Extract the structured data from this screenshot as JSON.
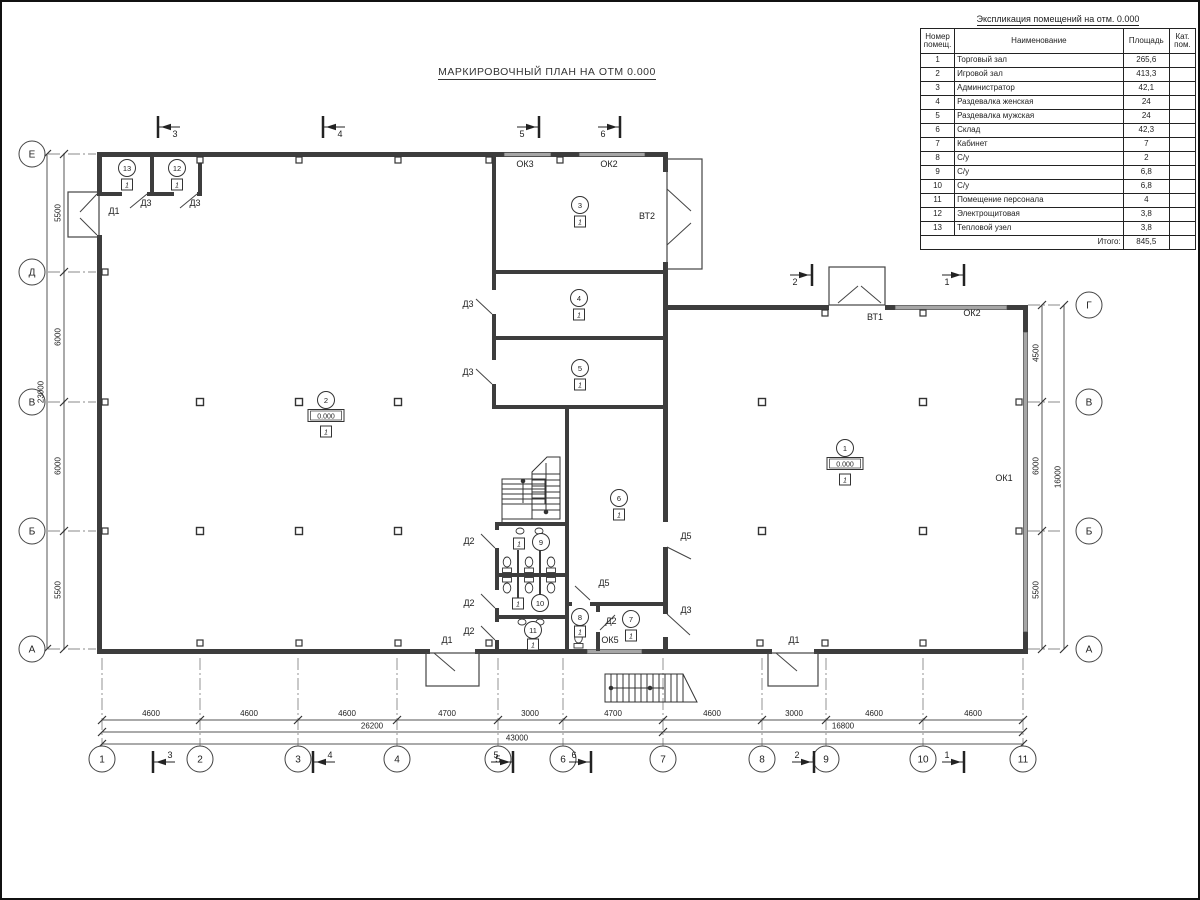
{
  "plan_title": "МАРКИРОВОЧНЫЙ ПЛАН НА ОТМ 0.000",
  "table": {
    "title": "Экспликация помещений на отм. 0.000",
    "h_num1": "Номер",
    "h_num2": "помещ.",
    "h_name": "Наименование",
    "h_area": "Площадь",
    "h_cat1": "Кат.",
    "h_cat2": "пом.",
    "rows": [
      {
        "n": "1",
        "name": "Торговый зал",
        "area": "265,6",
        "cat": ""
      },
      {
        "n": "2",
        "name": "Игровой зал",
        "area": "413,3",
        "cat": ""
      },
      {
        "n": "3",
        "name": "Администратор",
        "area": "42,1",
        "cat": ""
      },
      {
        "n": "4",
        "name": "Раздевалка женская",
        "area": "24",
        "cat": ""
      },
      {
        "n": "5",
        "name": "Раздевалка мужская",
        "area": "24",
        "cat": ""
      },
      {
        "n": "6",
        "name": "Склад",
        "area": "42,3",
        "cat": ""
      },
      {
        "n": "7",
        "name": "Кабинет",
        "area": "7",
        "cat": ""
      },
      {
        "n": "8",
        "name": "С/у",
        "area": "2",
        "cat": ""
      },
      {
        "n": "9",
        "name": "С/у",
        "area": "6,8",
        "cat": ""
      },
      {
        "n": "10",
        "name": "С/у",
        "area": "6,8",
        "cat": ""
      },
      {
        "n": "11",
        "name": "Помещение персонала",
        "area": "4",
        "cat": ""
      },
      {
        "n": "12",
        "name": "Электрощитовая",
        "area": "3,8",
        "cat": ""
      },
      {
        "n": "13",
        "name": "Тепловой узел",
        "area": "3,8",
        "cat": ""
      }
    ],
    "total_label": "Итого:",
    "total_value": "845,5"
  },
  "axes": {
    "bottom": [
      {
        "label": "1",
        "x": 100
      },
      {
        "label": "2",
        "x": 198
      },
      {
        "label": "3",
        "x": 296
      },
      {
        "label": "4",
        "x": 395
      },
      {
        "label": "5",
        "x": 496
      },
      {
        "label": "6",
        "x": 561
      },
      {
        "label": "7",
        "x": 661
      },
      {
        "label": "8",
        "x": 760
      },
      {
        "label": "9",
        "x": 824
      },
      {
        "label": "10",
        "x": 921
      },
      {
        "label": "11",
        "x": 1021
      }
    ],
    "left": [
      {
        "label": "Е",
        "y": 152
      },
      {
        "label": "Д",
        "y": 270
      },
      {
        "label": "В",
        "y": 400
      },
      {
        "label": "Б",
        "y": 529
      },
      {
        "label": "А",
        "y": 647
      }
    ],
    "right": [
      {
        "label": "Г",
        "y": 303
      },
      {
        "label": "В",
        "y": 400
      },
      {
        "label": "Б",
        "y": 529
      },
      {
        "label": "А",
        "y": 647
      }
    ]
  },
  "dims": {
    "bottom_row1": [
      {
        "text": "4600",
        "x": 149
      },
      {
        "text": "4600",
        "x": 247
      },
      {
        "text": "4600",
        "x": 345
      },
      {
        "text": "4700",
        "x": 445
      },
      {
        "text": "3000",
        "x": 528
      },
      {
        "text": "4700",
        "x": 611
      },
      {
        "text": "4600",
        "x": 710
      },
      {
        "text": "3000",
        "x": 792
      },
      {
        "text": "4600",
        "x": 872
      },
      {
        "text": "4600",
        "x": 971
      }
    ],
    "bottom_row2": [
      {
        "text": "26200",
        "x": 370
      },
      {
        "text": "16800",
        "x": 841
      }
    ],
    "bottom_total": {
      "text": "43000",
      "x": 515
    },
    "left_col": [
      {
        "text": "5500",
        "y": 211
      },
      {
        "text": "6000",
        "y": 335
      },
      {
        "text": "6000",
        "y": 464
      },
      {
        "text": "5500",
        "y": 588
      }
    ],
    "left_total": {
      "text": "23000",
      "y": 390
    },
    "right_col": [
      {
        "text": "4500",
        "y": 351
      },
      {
        "text": "6000",
        "y": 464
      },
      {
        "text": "5500",
        "y": 588
      }
    ],
    "right_total": {
      "text": "16000",
      "y": 475
    }
  },
  "sections": {
    "top": [
      {
        "label": "3",
        "x": 156,
        "y": 125,
        "dir": "left"
      },
      {
        "label": "4",
        "x": 321,
        "y": 125,
        "dir": "left"
      },
      {
        "label": "5",
        "x": 537,
        "y": 125,
        "dir": "right"
      },
      {
        "label": "6",
        "x": 618,
        "y": 125,
        "dir": "right"
      }
    ],
    "top_right": [
      {
        "label": "2",
        "x": 810,
        "y": 273,
        "dir": "right"
      },
      {
        "label": "1",
        "x": 962,
        "y": 273,
        "dir": "right"
      }
    ],
    "bottom": [
      {
        "label": "3",
        "x": 151,
        "y": 760,
        "dir": "left"
      },
      {
        "label": "4",
        "x": 311,
        "y": 760,
        "dir": "left"
      },
      {
        "label": "5",
        "x": 511,
        "y": 760,
        "dir": "right"
      },
      {
        "label": "6",
        "x": 589,
        "y": 760,
        "dir": "right"
      },
      {
        "label": "2",
        "x": 812,
        "y": 760,
        "dir": "right"
      },
      {
        "label": "1",
        "x": 962,
        "y": 760,
        "dir": "right"
      }
    ]
  },
  "marks": {
    "doors": [
      {
        "text": "Д1",
        "x": 112,
        "y": 212
      },
      {
        "text": "Д1",
        "x": 445,
        "y": 641
      },
      {
        "text": "Д1",
        "x": 792,
        "y": 641
      },
      {
        "text": "Д3",
        "x": 144,
        "y": 204
      },
      {
        "text": "Д3",
        "x": 193,
        "y": 204
      },
      {
        "text": "Д3",
        "x": 466,
        "y": 305
      },
      {
        "text": "Д3",
        "x": 466,
        "y": 373
      },
      {
        "text": "Д3",
        "x": 684,
        "y": 611
      },
      {
        "text": "Д2",
        "x": 467,
        "y": 542
      },
      {
        "text": "Д2",
        "x": 467,
        "y": 604
      },
      {
        "text": "Д2",
        "x": 467,
        "y": 632
      },
      {
        "text": "Д2",
        "x": 609,
        "y": 622
      },
      {
        "text": "Д5",
        "x": 684,
        "y": 537
      },
      {
        "text": "Д5",
        "x": 602,
        "y": 584
      }
    ],
    "windows": [
      {
        "text": "ОК3",
        "x": 523,
        "y": 165
      },
      {
        "text": "ОК2",
        "x": 607,
        "y": 165
      },
      {
        "text": "ОК2",
        "x": 970,
        "y": 314
      },
      {
        "text": "ОК1",
        "x": 1002,
        "y": 479
      },
      {
        "text": "ОК5",
        "x": 608,
        "y": 641
      }
    ],
    "gates": [
      {
        "text": "ВТ2",
        "x": 645,
        "y": 217
      },
      {
        "text": "ВТ1",
        "x": 873,
        "y": 318
      }
    ]
  },
  "rooms": [
    {
      "num": "1",
      "x": 843,
      "y": 446,
      "elev": "0.000",
      "floor": "1"
    },
    {
      "num": "2",
      "x": 324,
      "y": 398,
      "elev": "0.000",
      "floor": "1"
    },
    {
      "num": "3",
      "x": 578,
      "y": 203,
      "floor": "1"
    },
    {
      "num": "4",
      "x": 577,
      "y": 296,
      "floor": "1"
    },
    {
      "num": "5",
      "x": 578,
      "y": 366,
      "floor": "1"
    },
    {
      "num": "6",
      "x": 617,
      "y": 496,
      "floor": "1"
    },
    {
      "num": "7",
      "x": 629,
      "y": 617,
      "floor": "1"
    },
    {
      "num": "8",
      "x": 578,
      "y": 615,
      "floor": "1",
      "fdy": 9
    },
    {
      "num": "9",
      "x": 539,
      "y": 540,
      "floor": "1",
      "fdx": -22,
      "fdy": -4
    },
    {
      "num": "10",
      "x": 538,
      "y": 601,
      "floor": "1",
      "fdx": -22,
      "fdy": -5
    },
    {
      "num": "11",
      "x": 531,
      "y": 628,
      "floor": "1",
      "fdy": 9
    },
    {
      "num": "12",
      "x": 175,
      "y": 166,
      "floor": "1"
    },
    {
      "num": "13",
      "x": 125,
      "y": 166,
      "floor": "1"
    }
  ]
}
